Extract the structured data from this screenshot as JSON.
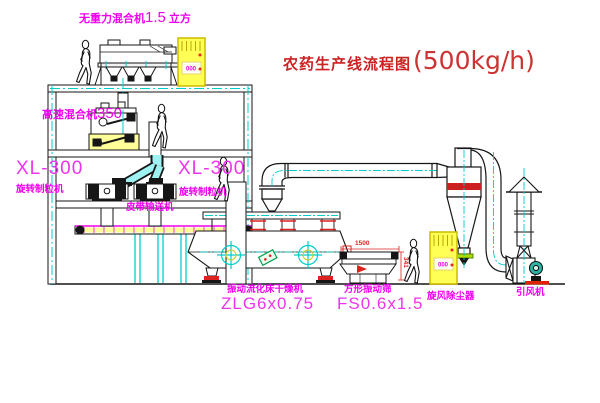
{
  "title": {
    "main": "农药生产线流程图",
    "capacity": "(500kg/h)"
  },
  "equipment_labels": {
    "gravity_mixer": {
      "name": "无重力混合机",
      "size": "1.5",
      "unit": "立方"
    },
    "high_speed_mixer": {
      "name": "高速混合机",
      "size": "350"
    },
    "granulator_left": {
      "model": "XL-300",
      "name": "旋转制粒机"
    },
    "granulator_right": {
      "model": "XL-300",
      "name": "旋转制粒机"
    },
    "belt_conveyor": {
      "name": "皮带输送机"
    },
    "fluid_bed_dryer": {
      "name": "振动流化床干燥机",
      "model": "ZLG6x0.75"
    },
    "square_sieve": {
      "name": "方形振动筛",
      "model": "FS0.6x1.5"
    },
    "cyclone": {
      "name": "旋风除尘器"
    },
    "induced_draft_fan": {
      "name": "引风机"
    }
  },
  "dimensions": {
    "sieve_width": "1500",
    "sieve_height": "341"
  },
  "control_cabinet": {
    "display": "000"
  },
  "colors": {
    "line": "#161616",
    "centerline_cyan": "#00cccc",
    "label_magenta": "#ee00ee",
    "title_red": "#cc2222",
    "cabinet_yellow": "#ffff55",
    "motor_green": "#2ab5a5",
    "dim_red": "#dd2222",
    "chute_cyan": "#9ff2f2"
  }
}
